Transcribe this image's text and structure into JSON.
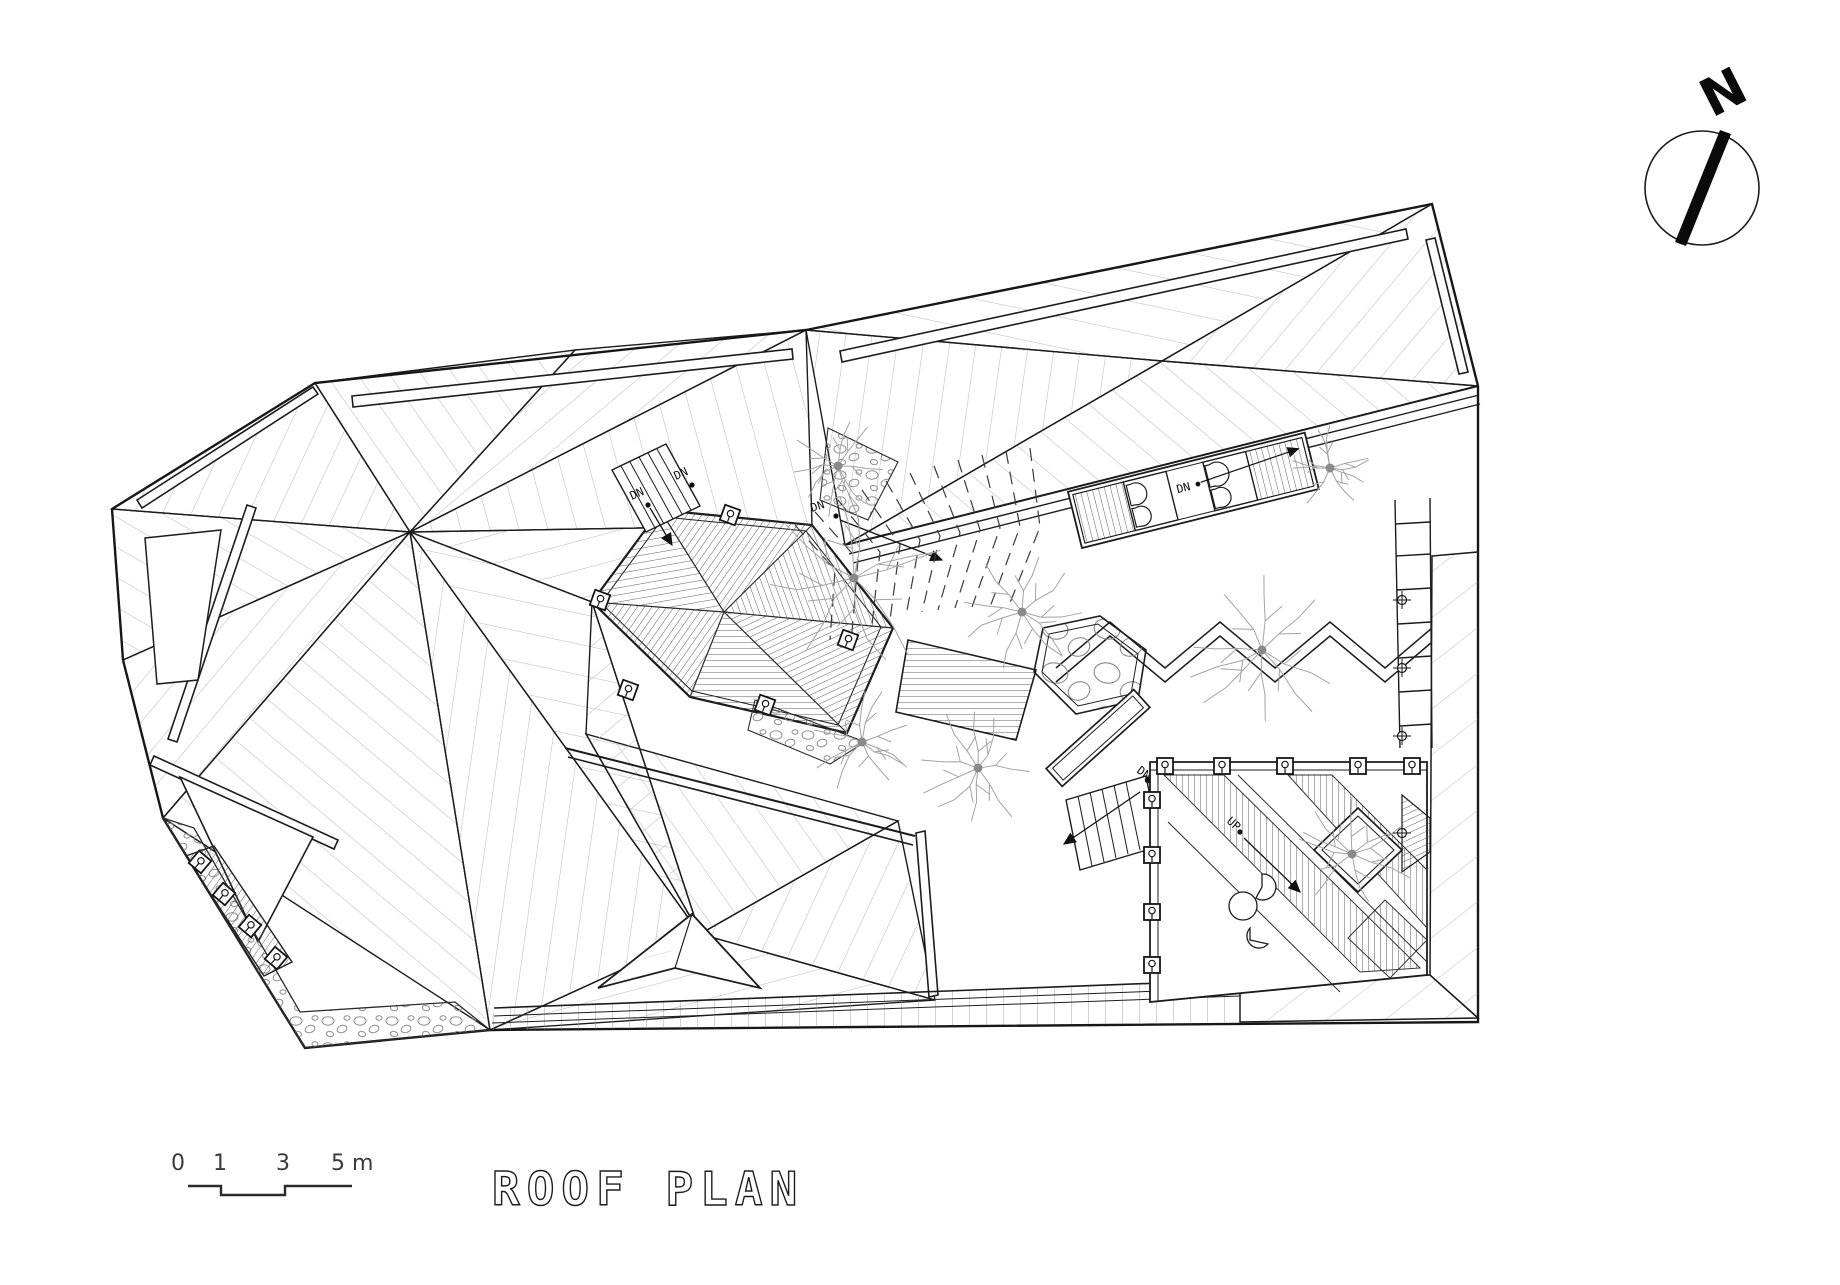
{
  "labels": {
    "north": "N",
    "title": "ROOF PLAN",
    "dn": "DN",
    "up": "UP"
  },
  "scale_bar": {
    "ticks": [
      "0",
      "1",
      "3",
      "5 m"
    ]
  },
  "colors": {
    "ink": "#1c1c1c",
    "mid": "#444444",
    "hatch": "#bcbcbc",
    "tree": "#a3a3a3",
    "tree_dot": "#8a8a8a",
    "background": "#ffffff"
  },
  "plan": {
    "trees": [
      {
        "x": 854,
        "y": 578,
        "r": 88,
        "seed": 3
      },
      {
        "x": 838,
        "y": 466,
        "r": 46,
        "seed": 5
      },
      {
        "x": 1022,
        "y": 612,
        "r": 58,
        "seed": 7
      },
      {
        "x": 862,
        "y": 742,
        "r": 50,
        "seed": 11
      },
      {
        "x": 1262,
        "y": 650,
        "r": 74,
        "seed": 13
      },
      {
        "x": 978,
        "y": 768,
        "r": 56,
        "seed": 17
      },
      {
        "x": 1352,
        "y": 854,
        "r": 56,
        "seed": 19
      },
      {
        "x": 1330,
        "y": 468,
        "r": 40,
        "seed": 23
      }
    ],
    "deck_posts": [
      {
        "x": 600,
        "y": 600,
        "rot": 20
      },
      {
        "x": 628,
        "y": 690,
        "rot": 20
      },
      {
        "x": 765,
        "y": 705,
        "rot": 20
      },
      {
        "x": 848,
        "y": 640,
        "rot": 20
      },
      {
        "x": 730,
        "y": 515,
        "rot": 20
      },
      {
        "x": 200,
        "y": 862,
        "rot": 40
      },
      {
        "x": 224,
        "y": 894,
        "rot": 40
      },
      {
        "x": 250,
        "y": 926,
        "rot": 40
      },
      {
        "x": 276,
        "y": 958,
        "rot": 40
      },
      {
        "x": 1165,
        "y": 766,
        "rot": 0
      },
      {
        "x": 1222,
        "y": 766,
        "rot": 0
      },
      {
        "x": 1285,
        "y": 766,
        "rot": 0
      },
      {
        "x": 1358,
        "y": 766,
        "rot": 0
      },
      {
        "x": 1412,
        "y": 766,
        "rot": 0
      },
      {
        "x": 1152,
        "y": 800,
        "rot": 0
      },
      {
        "x": 1152,
        "y": 855,
        "rot": 0
      },
      {
        "x": 1152,
        "y": 912,
        "rot": 0
      },
      {
        "x": 1152,
        "y": 965,
        "rot": 0
      }
    ],
    "circle_posts": [
      {
        "x": 1402,
        "y": 600
      },
      {
        "x": 1402,
        "y": 668
      },
      {
        "x": 1402,
        "y": 736
      },
      {
        "x": 1402,
        "y": 833
      }
    ]
  }
}
